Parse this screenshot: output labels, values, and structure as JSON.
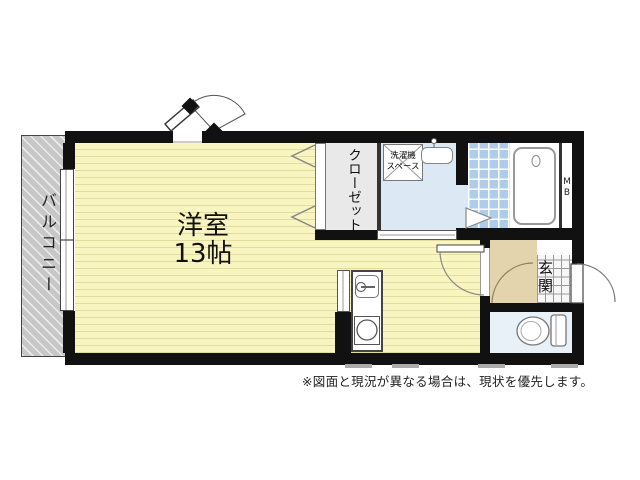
{
  "floorplan": {
    "balcony": {
      "label": "バルコニー"
    },
    "main_room": {
      "label": "洋室",
      "size": "13帖"
    },
    "closet": {
      "label": "クローゼット"
    },
    "laundry": {
      "line1": "洗濯機",
      "line2": "スペース"
    },
    "entrance": {
      "label": "玄関"
    },
    "meter_box": {
      "label": "MB"
    },
    "note": "※図面と現況が異なる場合は、現状を優先します。",
    "colors": {
      "room_fill": "#f9f5c0",
      "balcony_fill": "#c7c7c7",
      "water_area_fill": "#dce8f3",
      "bath_tile_fill": "#aecdeb",
      "toilet_fill": "#e8f0f8",
      "entrance_hall_fill": "#e3d4ae",
      "wall": "#111111"
    }
  }
}
